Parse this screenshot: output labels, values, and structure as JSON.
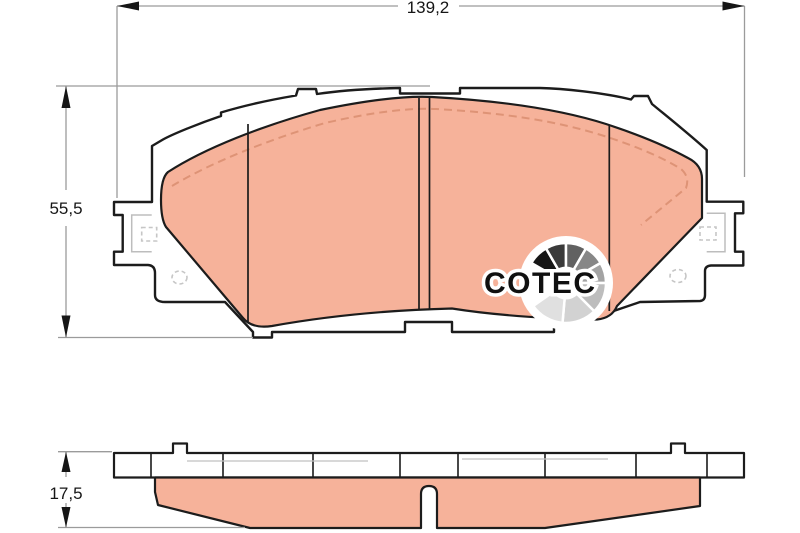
{
  "dimensions": {
    "width_label": "139,2",
    "height_label": "55,5",
    "thickness_label": "17,5"
  },
  "logo": {
    "text": "COTEC",
    "fan": {
      "cx": 566,
      "cy": 283,
      "outer_ring_r": 47,
      "wedge_r": 40,
      "inner_r": 16.5,
      "segments": [
        {
          "from": 150,
          "to": 120,
          "color": "#161616"
        },
        {
          "from": 120,
          "to": 90,
          "color": "#3a3a3a"
        },
        {
          "from": 90,
          "to": 60,
          "color": "#616161"
        },
        {
          "from": 60,
          "to": 30,
          "color": "#878787"
        },
        {
          "from": 30,
          "to": 0,
          "color": "#a3a3a3"
        },
        {
          "from": 0,
          "to": -45,
          "color": "#bdbdbd"
        },
        {
          "from": -45,
          "to": -95,
          "color": "#d2d2d2"
        },
        {
          "from": -95,
          "to": -145,
          "color": "#e0e0e0"
        }
      ]
    }
  },
  "colors": {
    "friction": "#f6b29a",
    "chamfer_dash": "#de9376",
    "outline": "#1c1c1c",
    "dimension_line": "#9b9b9b",
    "hidden_detail": "#c6c6c6",
    "background": "#ffffff"
  }
}
